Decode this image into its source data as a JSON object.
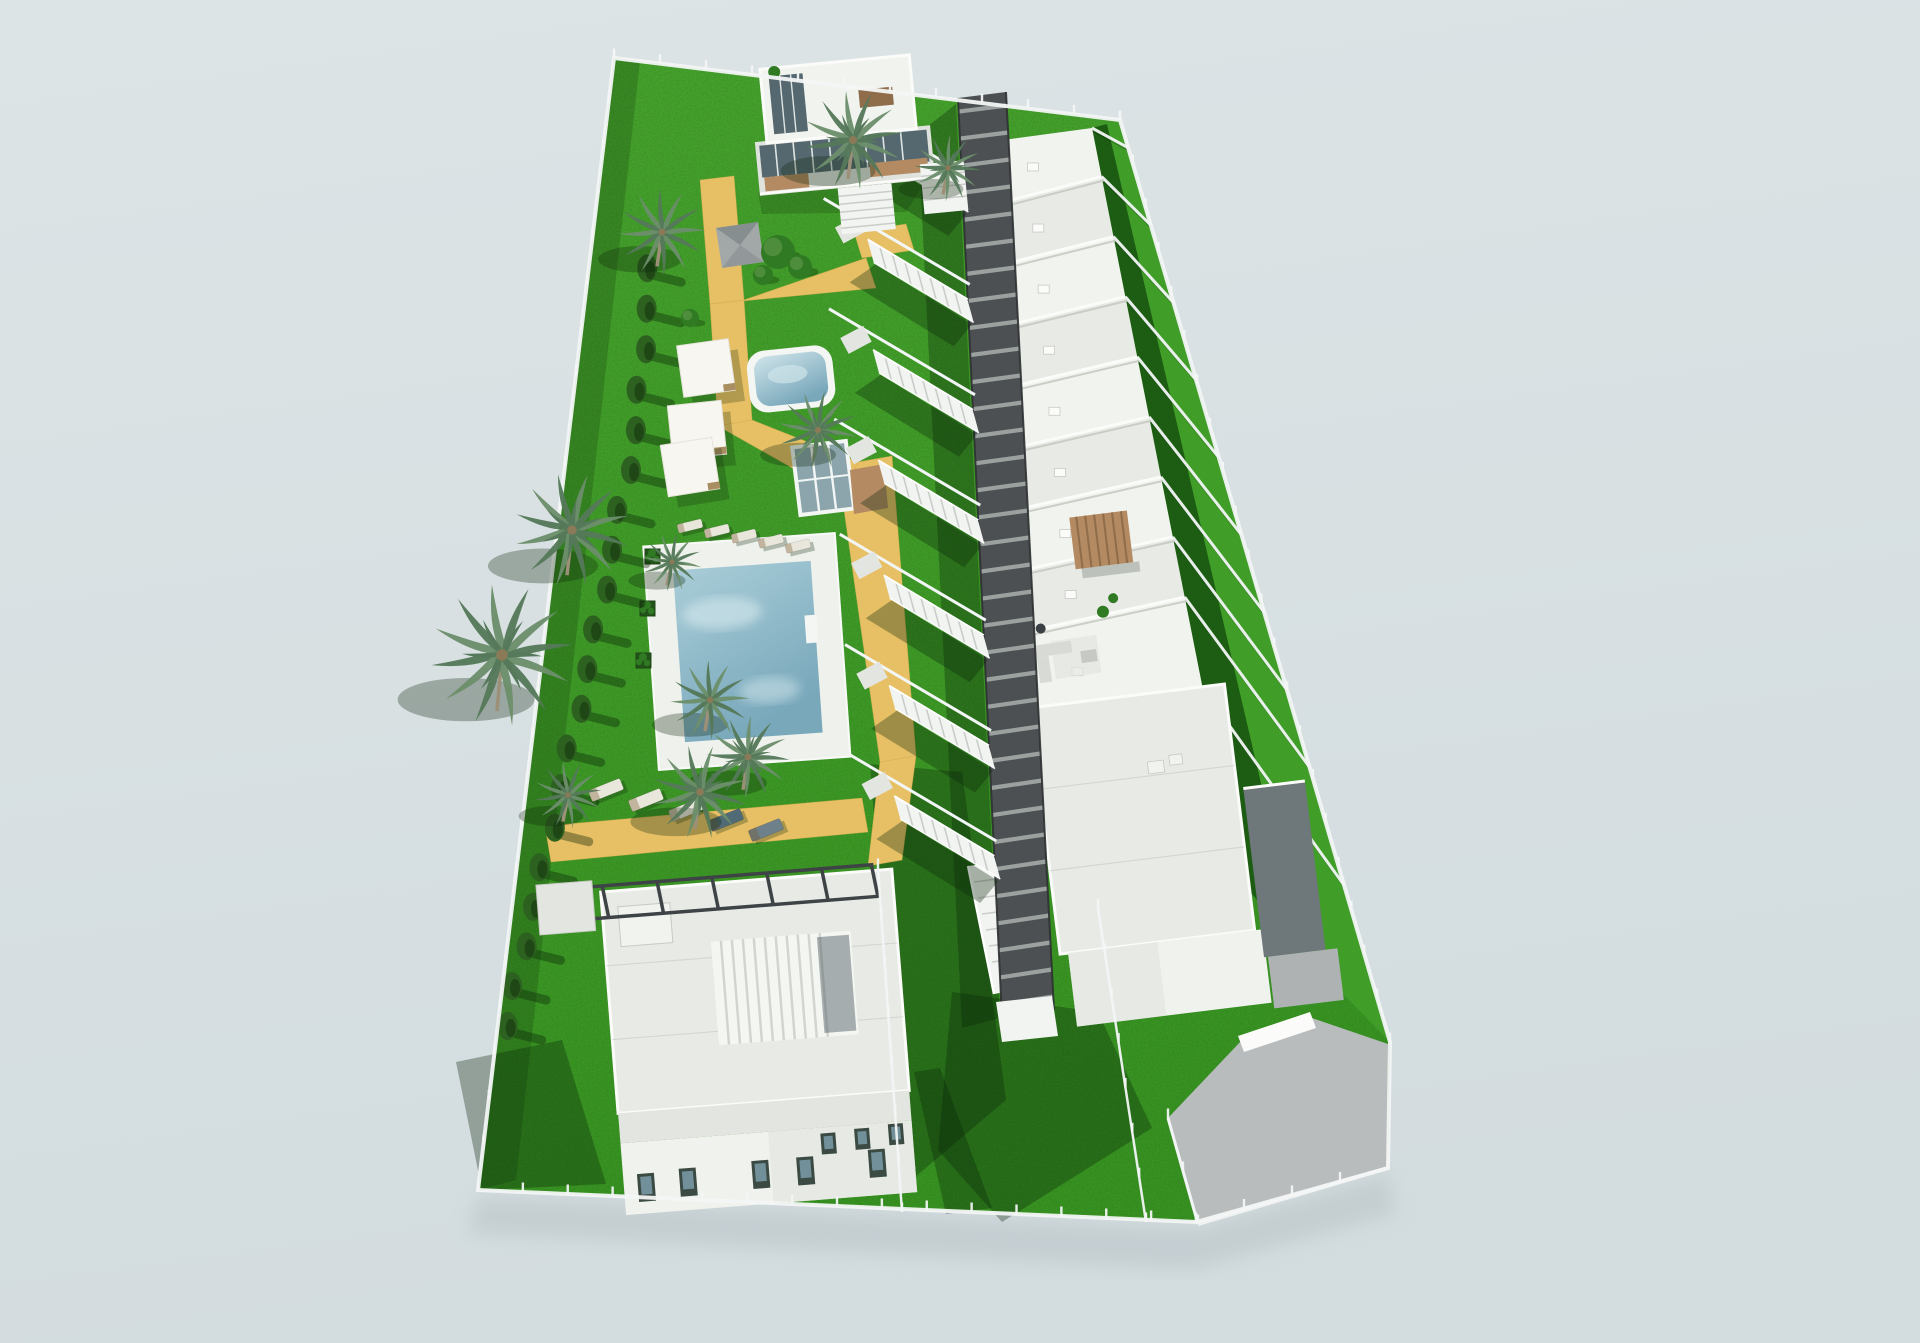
{
  "scene": {
    "type": "architectural-render",
    "description": "Aerial 3D architectural render of a coastal residential development: a diagonal row of white flat-roofed townhouses served by an elevated dark pergola walkway with staircases, communal gardens with two swimming pools, palm trees, cypress hedge, sun loungers and shade sails, a modern villa at the top and a large villa with white slatted pergola at the bottom, private back gardens, perimeter glass fence and a grey driveway, all on a pale blue-grey background."
  },
  "counts": {
    "townhouses": 10,
    "privateBackGardens": 9,
    "walkwayStaircases": 7,
    "swimmingPools": 2,
    "detachedVillas": 2,
    "palmTrees": 11,
    "shadeSails": 3,
    "sunLoungers": 10,
    "hedgeTrees": 20,
    "walkwayRungs": 34
  },
  "colors": {
    "bgTop": "#dde4e6",
    "bgBottom": "#d3dcdf",
    "grassTop": "#46a32d",
    "grassBottom": "#389422",
    "gardenDark": "#1d5c13",
    "gardenBright": "#3f9d28",
    "shadow": "rgba(10,36,8,0.33)",
    "hedge": "#2d6120",
    "hedgeDark": "#1e4715",
    "palmA": "#6c8f6b",
    "palmB": "#55795a",
    "palmHeart": "#8a7a58",
    "trunk": "#9d9078",
    "path": "#e7c065",
    "pathEdge": "#d9ae52",
    "deck": "#eff1ec",
    "rim": "#f3f6f3",
    "poolDeep": "#79a8bb",
    "poolLight": "#a9cdd8",
    "poolPale": "#cfe4ea",
    "roof": "#e8eae5",
    "roofLight": "#f1f3ee",
    "roofShade": "#dfe1db",
    "roofLine": "#c7cac3",
    "parapet": "#fbfcfa",
    "facade": "#f0f2ee",
    "facadeShade": "#e0e2dd",
    "concrete": "#e3e5e0",
    "windowFrame": "#3c4a44",
    "glass": "#72909a",
    "glazing": "#55686f",
    "walkway": "#4c5052",
    "rung": "#9ba19f",
    "rail": "#2e3132",
    "stair": "#f2f4f1",
    "stairLine": "#c9cdc9",
    "fence": "#f3f6f6",
    "drive": "#b8bcbd",
    "ramp": "#aeb2b3",
    "wood": "#b38a62",
    "woodDark": "#8f6c4a",
    "pergolaBeam": "#3e4346",
    "gazebo": "#a2a8a8",
    "gazeboDark": "#878e8f",
    "sail": "#f7f6f0",
    "loungerWhite": "#e9e6db",
    "loungerDark": "#506a76",
    "loungerGray": "#6e8089",
    "loungerWood": "#a88e60",
    "bush": "#2f7a22",
    "bushDark": "#23521a",
    "darkWall": "#6e7779"
  },
  "geometry": {
    "perimeter": [
      [
        614,
        58
      ],
      [
        1120,
        120
      ],
      [
        1390,
        1042
      ],
      [
        1388,
        1168
      ],
      [
        1196,
        1222
      ],
      [
        478,
        1190
      ]
    ],
    "walkwayLeft": [
      958,
      98,
      1002,
      1018
    ],
    "walkwayRight": [
      1006,
      92,
      1054,
      1010
    ],
    "roofLeft": [
      1003,
      140,
      1028,
      726
    ],
    "roofRight": [
      1092,
      128,
      1205,
      700
    ],
    "fenceRight": [
      1120,
      120,
      1390,
      1042
    ],
    "rungCount": 34,
    "dividerT": [
      0.105,
      0.21,
      0.315,
      0.42,
      0.525,
      0.63,
      0.735,
      0.84
    ],
    "stairT": [
      0.1,
      0.22,
      0.34,
      0.46,
      0.585,
      0.705,
      0.825
    ],
    "postEdges": [
      [
        614,
        58,
        1120,
        120
      ],
      [
        1120,
        120,
        1390,
        1042
      ],
      [
        614,
        58,
        478,
        1190
      ],
      [
        478,
        1190,
        1196,
        1222
      ],
      [
        1196,
        1222,
        1388,
        1168
      ],
      [
        878,
        868,
        902,
        1212
      ],
      [
        1098,
        908,
        1146,
        1222
      ],
      [
        1168,
        1118,
        1198,
        1224
      ]
    ],
    "postSpacing": 46,
    "hedgePath": [
      [
        652,
        248
      ],
      [
        636,
        430
      ],
      [
        596,
        630
      ],
      [
        556,
        810
      ],
      [
        518,
        970
      ],
      [
        504,
        1046
      ]
    ],
    "hedgeCount": 20
  },
  "items": {
    "palms": [
      {
        "x": 853,
        "y": 140,
        "r": 50
      },
      {
        "x": 662,
        "y": 232,
        "r": 44
      },
      {
        "x": 948,
        "y": 168,
        "r": 34
      },
      {
        "x": 818,
        "y": 430,
        "r": 40
      },
      {
        "x": 572,
        "y": 530,
        "r": 58
      },
      {
        "x": 502,
        "y": 655,
        "r": 72
      },
      {
        "x": 710,
        "y": 700,
        "r": 40
      },
      {
        "x": 748,
        "y": 757,
        "r": 42
      },
      {
        "x": 672,
        "y": 562,
        "r": 30
      },
      {
        "x": 700,
        "y": 792,
        "r": 48
      },
      {
        "x": 568,
        "y": 795,
        "r": 34
      }
    ],
    "sails": [
      {
        "x": 706,
        "y": 368,
        "s": 52,
        "rot": -8
      },
      {
        "x": 697,
        "y": 430,
        "s": 54,
        "rot": -6
      },
      {
        "x": 690,
        "y": 467,
        "s": 52,
        "rot": -9
      }
    ],
    "loungerRows": [
      {
        "x": 690,
        "y": 526,
        "dx": 27,
        "dy": 5,
        "rot": -14,
        "len": 25,
        "wid": 9,
        "cols": [
          "loungerWhite",
          "loungerWhite",
          "loungerWhite",
          "loungerWhite",
          "loungerWhite"
        ]
      },
      {
        "x": 606,
        "y": 790,
        "dx": 40,
        "dy": 10,
        "rot": -22,
        "len": 34,
        "wid": 12,
        "cols": [
          "loungerWhite",
          "loungerWhite",
          "loungerWhite",
          "loungerDark",
          "loungerGray"
        ]
      }
    ],
    "planters": [
      [
        652,
        556
      ],
      [
        647,
        608
      ],
      [
        643,
        660
      ]
    ],
    "bushes": [
      {
        "x": 778,
        "y": 252,
        "r": 17
      },
      {
        "x": 800,
        "y": 267,
        "r": 12
      },
      {
        "x": 763,
        "y": 275,
        "r": 10
      },
      {
        "x": 690,
        "y": 318,
        "r": 9
      }
    ]
  }
}
